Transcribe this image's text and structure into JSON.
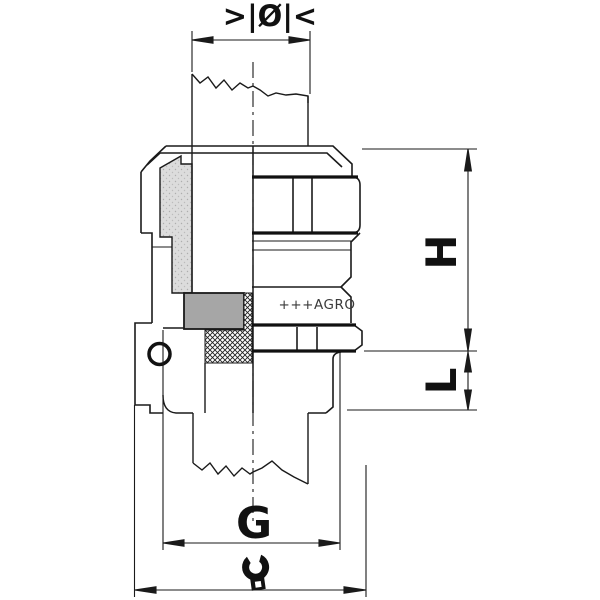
{
  "drawing": {
    "type": "technical-drawing",
    "subject": "cable gland half-section with mounted cable",
    "brand_marking": "+++AGRO",
    "dimension_labels": {
      "cable_diameter_symbol": ">|Ø|<",
      "height": "H",
      "thread_length": "L",
      "thread_size": "G"
    },
    "icons": {
      "wrench": "open-end-wrench"
    },
    "colors": {
      "line": "#1a1a1a",
      "section_fill": "#dcdcdc",
      "insert_fill": "#a6a6a6",
      "background": "#ffffff"
    }
  }
}
